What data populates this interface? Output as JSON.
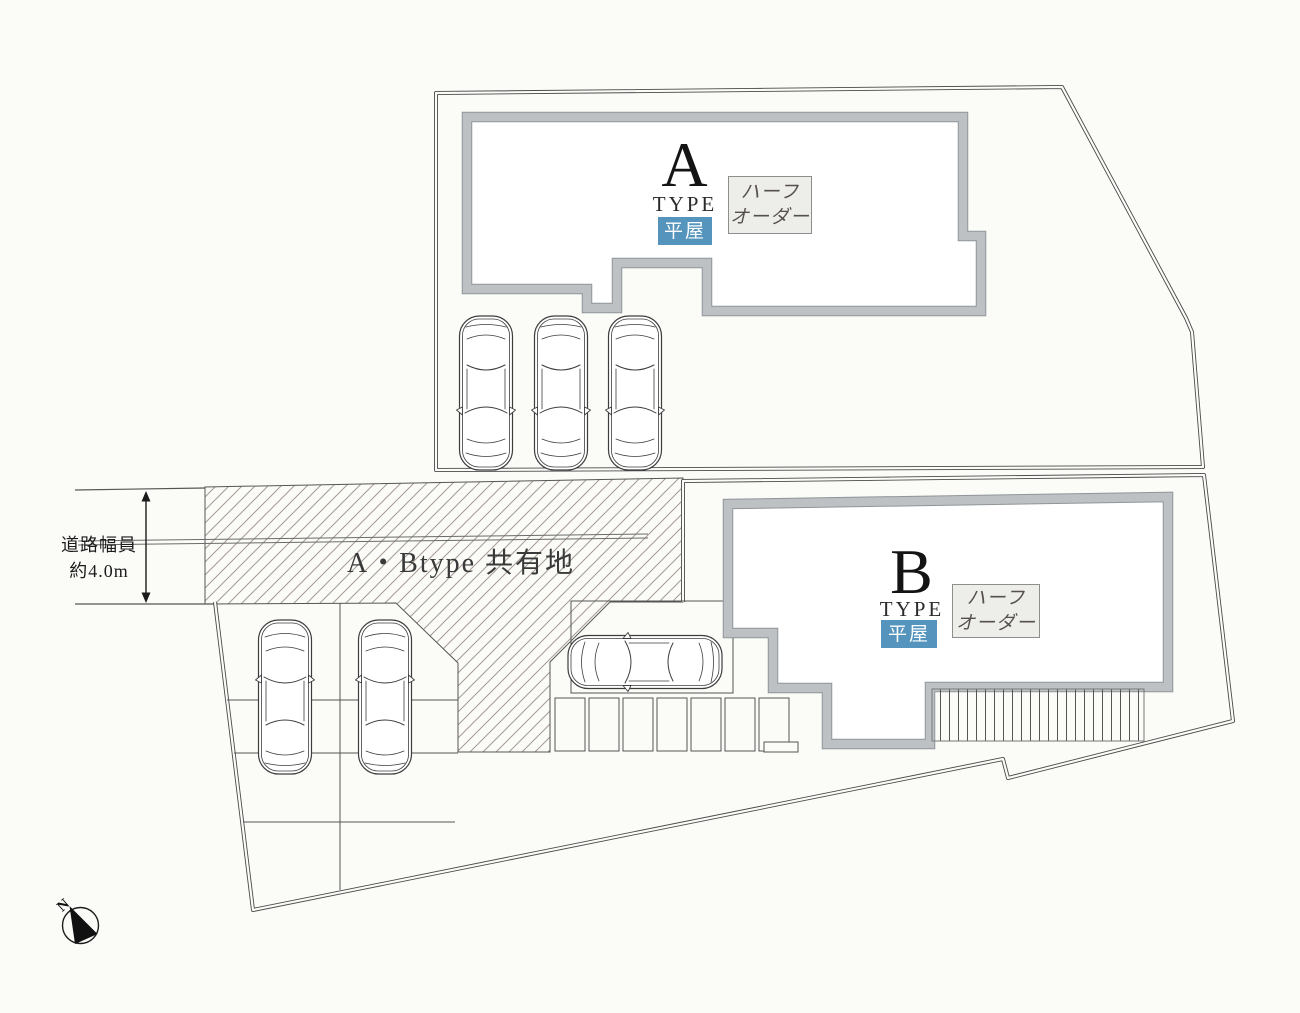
{
  "canvas": {
    "width": 1300,
    "height": 1013,
    "background": "#fbfbf8"
  },
  "buildings": {
    "a": {
      "letter": "A",
      "type": "TYPE",
      "storey": "平屋",
      "order_line1": "ハーフ",
      "order_line2": "オーダー"
    },
    "b": {
      "letter": "B",
      "type": "TYPE",
      "storey": "平屋",
      "order_line1": "ハーフ",
      "order_line2": "オーダー"
    }
  },
  "labels": {
    "shared_area": "A・Btype 共有地",
    "road_width_line1": "道路幅員",
    "road_width_line2": "約4.0m",
    "compass": "N"
  },
  "cars": {
    "upper_lot_count": 3,
    "lower_lot_count": 2,
    "approach_count": 1
  },
  "colors": {
    "wall_fill": "#bdc1c4",
    "wall_edge": "#8f9598",
    "boundary_line": "#4a4a4a",
    "thin_line": "#555555",
    "hatch_line": "#a59b94",
    "storey_badge_bg": "#5595bd",
    "storey_badge_text": "#ffffff",
    "order_box_bg": "#ededea",
    "order_box_border": "#8e8e8e",
    "order_box_text": "#55504c"
  }
}
